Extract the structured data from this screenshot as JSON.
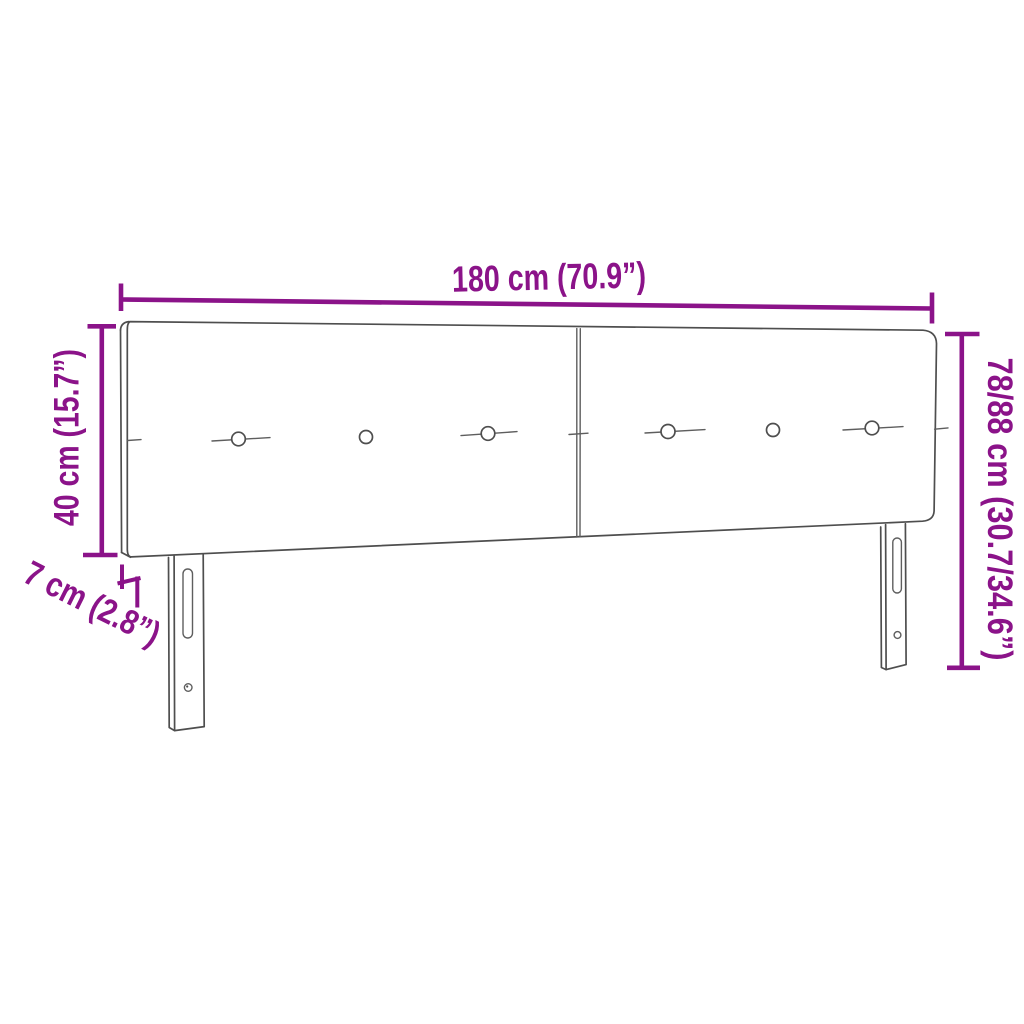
{
  "diagram": {
    "subject": "upholstered-headboard-with-two-panels-and-legs",
    "width_label": "180 cm (70.9”)",
    "panel_height_label": "40 cm (15.7”)",
    "total_height_label": "78/88 cm (30.7/34.6”)",
    "depth_label": "7 cm (2.8”)",
    "colors": {
      "dimension_accent": "#8B1389",
      "sketch_line": "#4E4E4E",
      "background": "#FFFFFF"
    }
  }
}
